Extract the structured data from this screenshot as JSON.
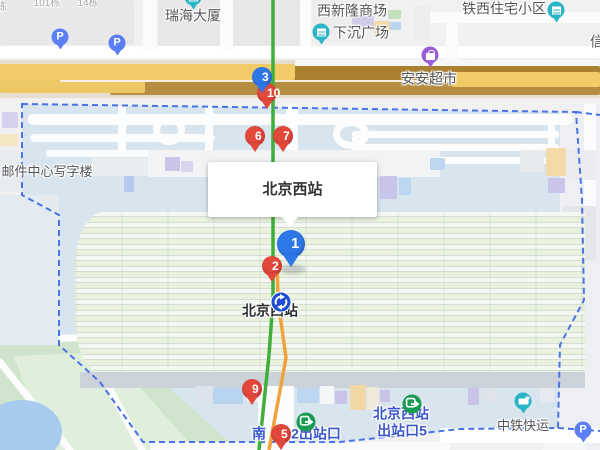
{
  "map": {
    "info_box": {
      "title": "北京西站"
    },
    "colors": {
      "marker_red": "#e2473c",
      "marker_blue": "#2e77e6",
      "parking_blue": "#5b7ef5",
      "poi_teal": "#29b4c8",
      "poi_purple": "#9a5fd6",
      "exit_green": "#199a53",
      "metro_blue": "#1d4ed2",
      "boundary_blue": "#4a73e8",
      "line_green": "#3fae3a",
      "line_orange": "#f0a23c",
      "exit_text_blue": "#3c58c8"
    },
    "numbered_markers": [
      {
        "n": "10",
        "color": "red",
        "x": 267,
        "y": 93,
        "large": false
      },
      {
        "n": "3",
        "color": "blue",
        "x": 262,
        "y": 77,
        "large": false
      },
      {
        "n": "6",
        "color": "red",
        "x": 255,
        "y": 136,
        "large": false
      },
      {
        "n": "7",
        "color": "red",
        "x": 283,
        "y": 136,
        "large": false
      },
      {
        "n": "1",
        "color": "blue",
        "x": 291,
        "y": 244,
        "large": true
      },
      {
        "n": "2",
        "color": "red",
        "x": 272,
        "y": 266,
        "large": false
      },
      {
        "n": "9",
        "color": "red",
        "x": 252,
        "y": 389,
        "large": false
      },
      {
        "n": "5",
        "color": "red",
        "x": 281,
        "y": 434,
        "large": false
      }
    ],
    "parking_markers": [
      {
        "label": "P",
        "x": 60,
        "y": 37
      },
      {
        "label": "P",
        "x": 117,
        "y": 43
      },
      {
        "label": "P",
        "x": 583,
        "y": 430
      }
    ],
    "poi_markers": [
      {
        "icon": "building-icon",
        "color": "teal",
        "x": 193,
        "y": -3,
        "for": "瑞海大厦"
      },
      {
        "icon": "building-icon",
        "color": "teal",
        "x": 321,
        "y": 32,
        "for": "下沉广场"
      },
      {
        "icon": "building-icon",
        "color": "teal",
        "x": 556,
        "y": 10,
        "for": "铁西住宅小区"
      },
      {
        "icon": "shopping-icon",
        "color": "purple",
        "x": 430,
        "y": 55,
        "for": "安安超市"
      },
      {
        "icon": "truck-icon",
        "color": "teal",
        "x": 523,
        "y": 401,
        "for": "中铁快运"
      }
    ],
    "place_labels": [
      {
        "text": "101栋",
        "x": 47,
        "y": 4,
        "kind": "muted"
      },
      {
        "text": "14栋",
        "x": 88,
        "y": 4,
        "kind": "muted"
      },
      {
        "text": "栋",
        "x": 2,
        "y": 8,
        "kind": "muted"
      },
      {
        "text": "瑞海大厦",
        "x": 193,
        "y": 16,
        "kind": "poi"
      },
      {
        "text": "西新隆商场",
        "x": 352,
        "y": 11,
        "kind": "poi"
      },
      {
        "text": "下沉广场",
        "x": 361,
        "y": 33,
        "kind": "poi"
      },
      {
        "text": "铁西住宅小区",
        "x": 504,
        "y": 9,
        "kind": "poi"
      },
      {
        "text": "信",
        "x": 597,
        "y": 42,
        "kind": "poi"
      },
      {
        "text": "安安超市",
        "x": 429,
        "y": 79,
        "kind": "poi"
      },
      {
        "text": "邮件中心写字楼",
        "x": 47,
        "y": 172,
        "kind": "small"
      },
      {
        "text": "北京西站",
        "x": 270,
        "y": 311,
        "kind": "station"
      },
      {
        "text": "中铁快运",
        "x": 523,
        "y": 426,
        "kind": "small"
      }
    ],
    "exit_labels": [
      {
        "text": "南",
        "x": 259,
        "y": 434
      },
      {
        "text": "2出站口",
        "x": 316,
        "y": 434
      },
      {
        "text": "北京西站",
        "x": 401,
        "y": 414
      },
      {
        "text": "出站口5",
        "x": 402,
        "y": 431
      }
    ],
    "exit_icons": [
      {
        "x": 296,
        "y": 412
      },
      {
        "x": 402,
        "y": 394
      }
    ],
    "metro_icon": {
      "x": 270,
      "y": 291,
      "for": "北京西站"
    }
  }
}
